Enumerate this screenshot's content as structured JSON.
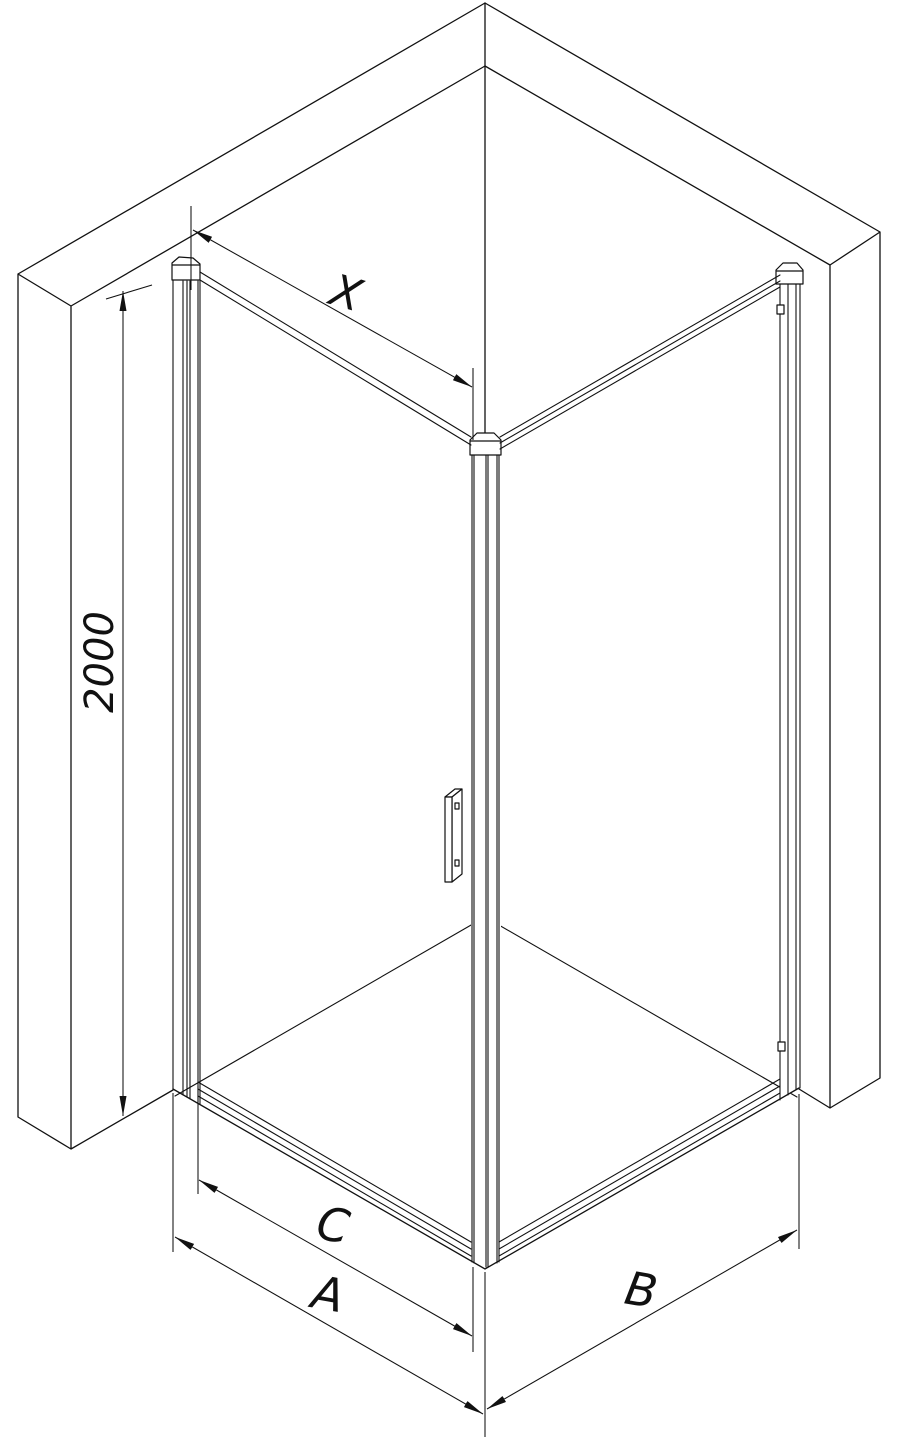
{
  "diagram": {
    "title": "Corner shower enclosure dimension drawing",
    "view": "isometric line drawing"
  },
  "dimensions": {
    "top_width_label": "X",
    "height_label": "2000",
    "door_width_label": "C",
    "front_width_label": "A",
    "side_width_label": "B"
  },
  "parts": {
    "left_wall": "wall",
    "right_wall": "wall",
    "shower_tray": "tray",
    "door": "hinged glass door",
    "side_panel": "fixed glass panel",
    "handle": "door handle"
  },
  "colors": {
    "line": "#111111",
    "background": "#ffffff"
  }
}
